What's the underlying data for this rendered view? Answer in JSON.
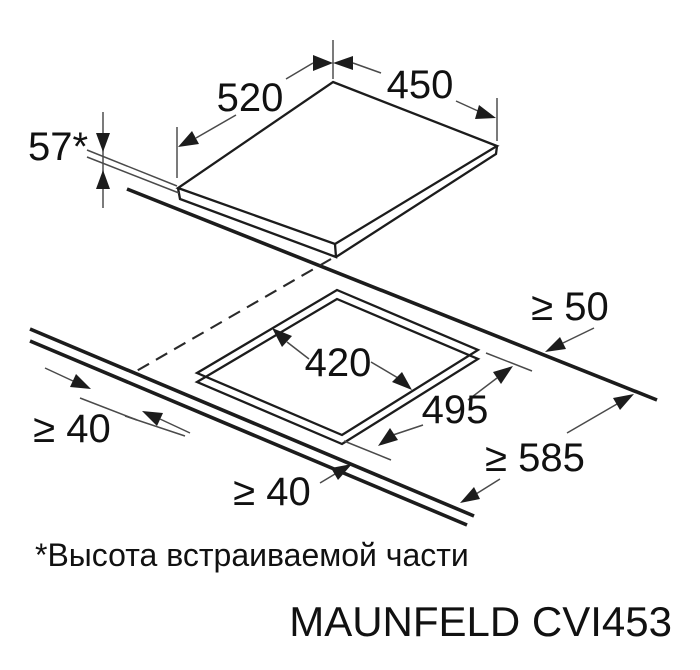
{
  "diagram": {
    "hob": {
      "width_label": "520",
      "depth_label": "450",
      "height_label": "57*"
    },
    "cutout": {
      "depth_label": "420",
      "width_label": "495"
    },
    "clearances": {
      "rear_label": "≥ 50",
      "side_label": "≥ 40",
      "front_label": "≥ 40",
      "worktop_depth_label": "≥ 585"
    },
    "colors": {
      "line": "#1c1c1c",
      "background": "#ffffff"
    }
  },
  "footnote": "*Высота встраиваемой части",
  "brand_model": "MAUNFELD CVI453"
}
